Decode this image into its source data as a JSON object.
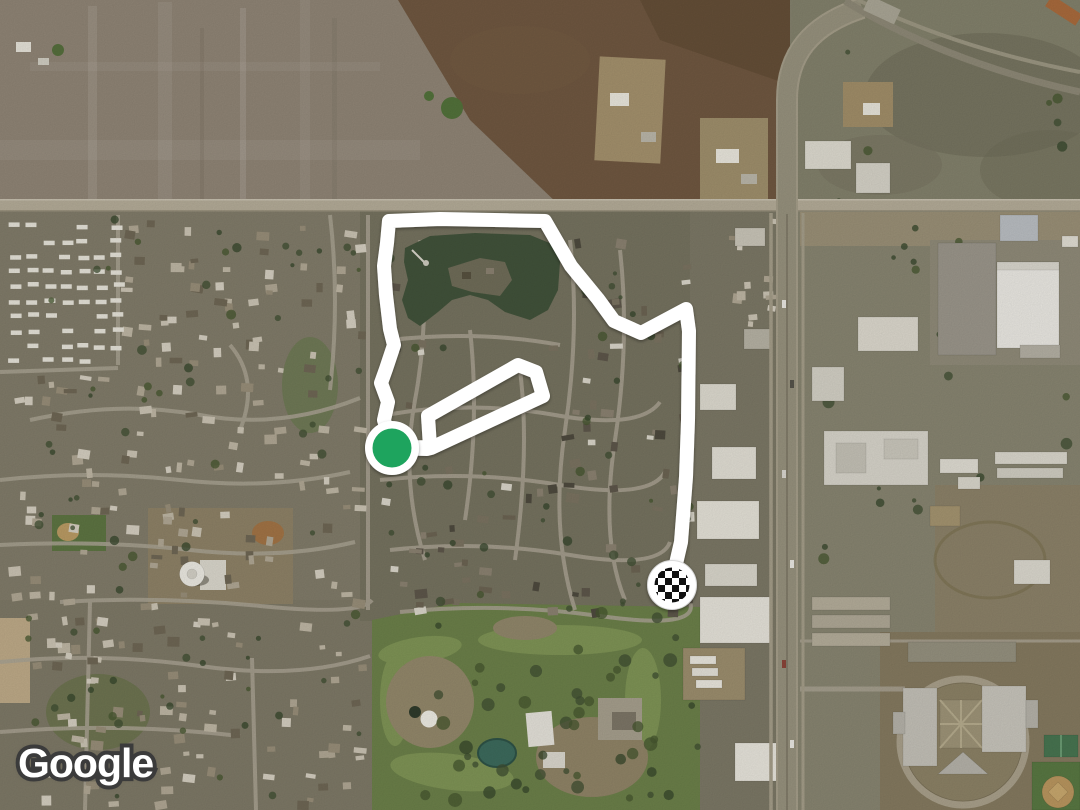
{
  "map": {
    "type": "satellite",
    "attribution": {
      "logo_text": "Google"
    },
    "route": {
      "stroke_color": "#ffffff",
      "stroke_width": 14,
      "points": [
        [
          392,
          448
        ],
        [
          427,
          449
        ],
        [
          431,
          448
        ],
        [
          543,
          396
        ],
        [
          536,
          372
        ],
        [
          518,
          365
        ],
        [
          428,
          416
        ],
        [
          430,
          447
        ],
        [
          392,
          448
        ],
        [
          384,
          420
        ],
        [
          388,
          402
        ],
        [
          381,
          383
        ],
        [
          386,
          369
        ],
        [
          394,
          345
        ],
        [
          390,
          329
        ],
        [
          386,
          295
        ],
        [
          384,
          266
        ],
        [
          387,
          243
        ],
        [
          389,
          221
        ],
        [
          440,
          219
        ],
        [
          545,
          221
        ],
        [
          571,
          266
        ],
        [
          598,
          299
        ],
        [
          614,
          321
        ],
        [
          641,
          333
        ],
        [
          686,
          309
        ],
        [
          689,
          331
        ],
        [
          688,
          420
        ],
        [
          686,
          477
        ],
        [
          681,
          542
        ],
        [
          672,
          581
        ]
      ],
      "start_marker": {
        "x": 392,
        "y": 448,
        "fill": "#1ea45e",
        "ring": "#ffffff",
        "label": "start"
      },
      "finish_marker": {
        "x": 672,
        "y": 585,
        "style": "checkered-flag",
        "colors": [
          "#111111",
          "#ffffff"
        ],
        "label": "finish"
      }
    }
  }
}
